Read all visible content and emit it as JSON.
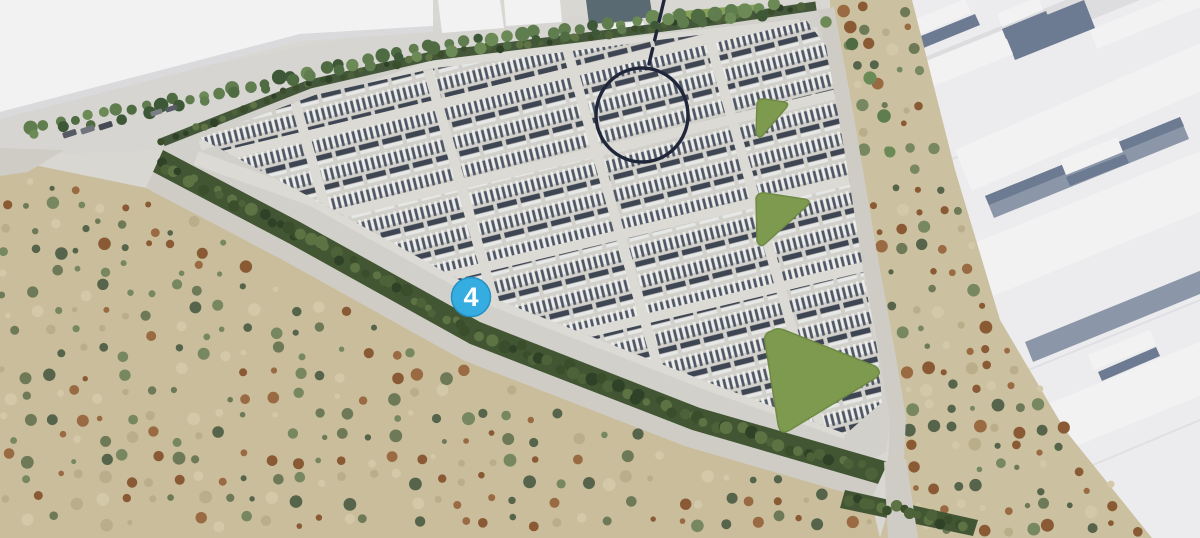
{
  "scene": {
    "type": "3d-aerial-site-rendering",
    "subject": "Triangular energy-storage site with rows of container units, bordered by hedges and roads, scrubland to the south-west, white industrial buildings to the north and east"
  },
  "marker": {
    "label": "4",
    "fill": "#35ade1",
    "ring": "#2491c6",
    "text_color": "#ffffff"
  },
  "annotation": {
    "highlight_color": "#20273a"
  },
  "palette": {
    "base": "#d8d7d2",
    "pad": "#d2d0ca",
    "road": "#cfccc5",
    "road_inner": "#dbdad4",
    "hedge": "#435634",
    "hedge_dots": [
      "#2f4227",
      "#4d6238",
      "#5d7343",
      "#3a4e2c"
    ],
    "lawn": "#7e9a4f",
    "lawn_top": "#87a258",
    "scrub_left": "#c9bd9c",
    "scrub_right": "#cbc09f",
    "scrub_dots": [
      "#6e7a57",
      "#55644a",
      "#9a6a42",
      "#8a5a35",
      "#d3c9a8",
      "#b9ad8a",
      "#77875f"
    ],
    "tree_colors": [
      "#3d5837",
      "#4f6b42",
      "#5f7d4e",
      "#6b8a56"
    ],
    "container_light": "#edeeec",
    "container_dark": "#505868",
    "container_slab": "#3e4553",
    "building_white": "#f2f2f3",
    "building_face": "#dadadd",
    "building_shadow": "#6d7b92",
    "building_gap": "#8b97a8",
    "building_ground": "#ececee",
    "seam": "#e0e0e4",
    "dark_roof": "#5a6a72",
    "car_colors": [
      "#555a63",
      "#70757d",
      "#464b53",
      "#7a7f86",
      "#585d65"
    ]
  }
}
